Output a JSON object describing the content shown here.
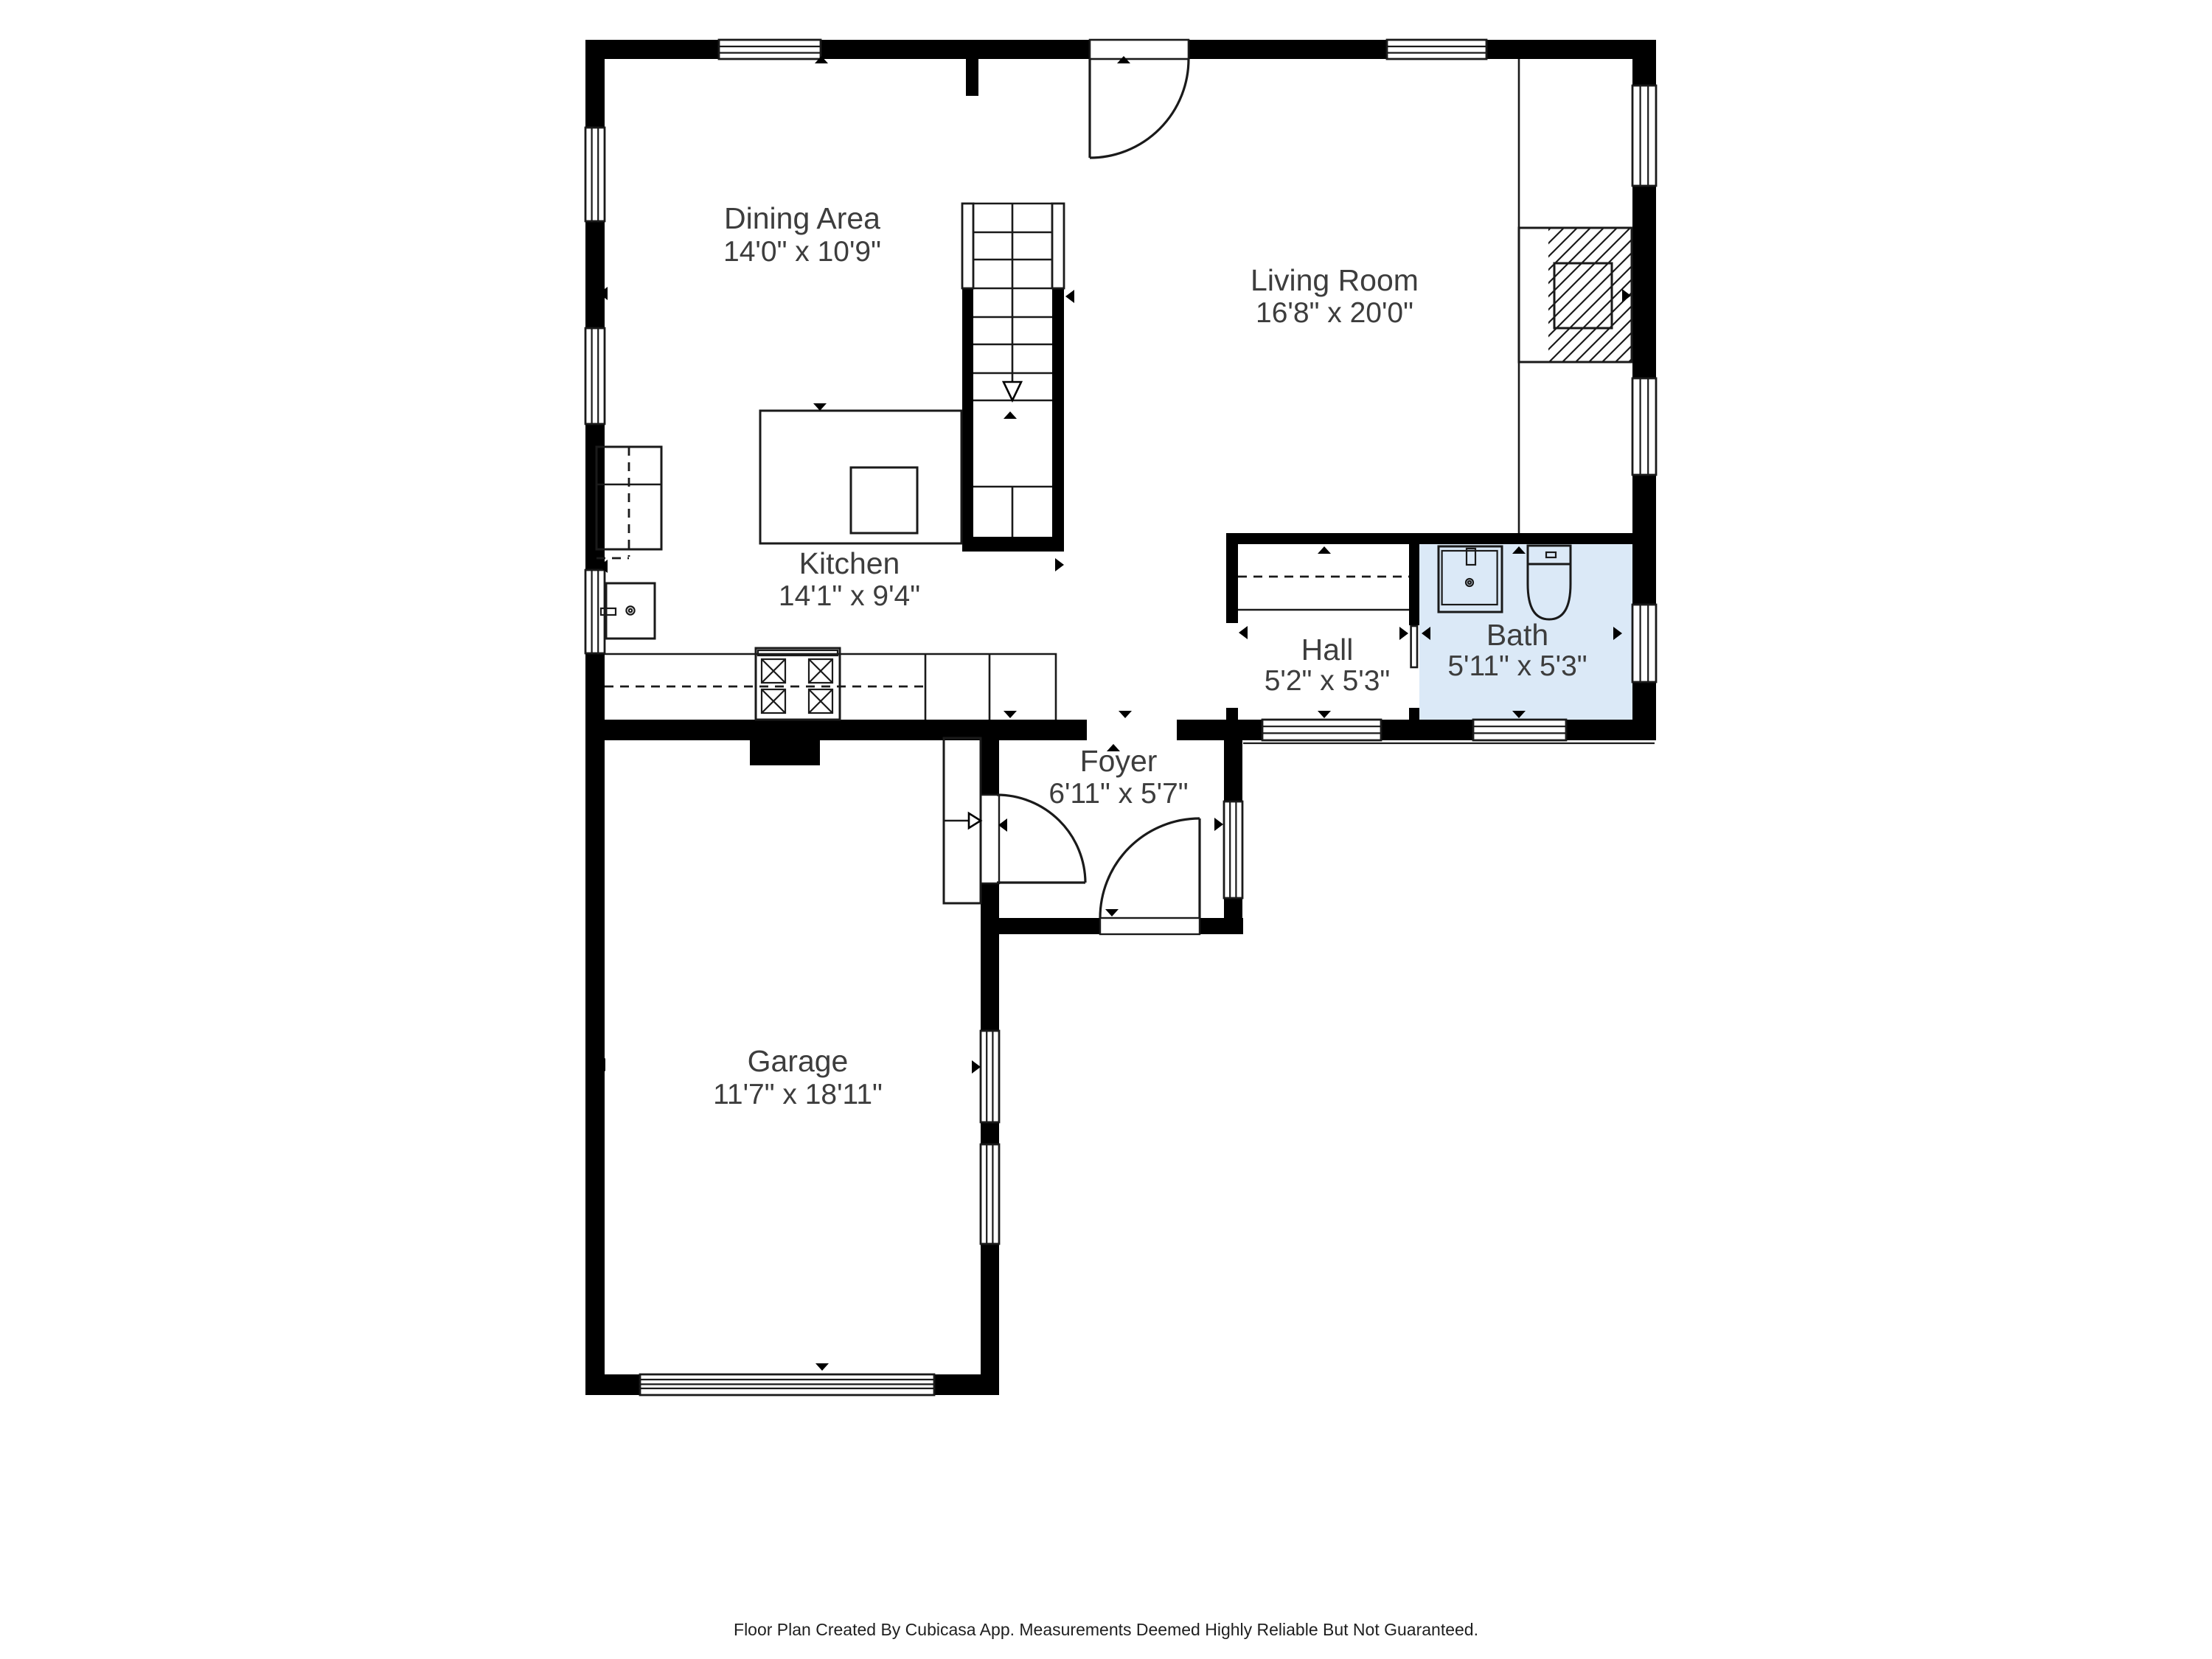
{
  "title": "Floor Plan",
  "colors": {
    "wall": "#000000",
    "line": "#1a1a1a",
    "bath_fill": "#dbe9f7",
    "label_text": "#3d3d3d",
    "background": "#ffffff"
  },
  "rooms": [
    {
      "id": "dining",
      "name": "Dining Area",
      "dims": "14'0\" x 10'9\""
    },
    {
      "id": "living",
      "name": "Living Room",
      "dims": "16'8\" x 20'0\""
    },
    {
      "id": "kitchen",
      "name": "Kitchen",
      "dims": "14'1\" x 9'4\""
    },
    {
      "id": "hall",
      "name": "Hall",
      "dims": "5'2\" x 5'3\""
    },
    {
      "id": "bath",
      "name": "Bath",
      "dims": "5'11\" x 5'3\""
    },
    {
      "id": "foyer",
      "name": "Foyer",
      "dims": "6'11\" x 5'7\""
    },
    {
      "id": "garage",
      "name": "Garage",
      "dims": "11'7\" x 18'11\""
    }
  ],
  "footer": {
    "text": "Floor Plan Created By Cubicasa App. Measurements Deemed Highly Reliable But Not Guaranteed."
  }
}
